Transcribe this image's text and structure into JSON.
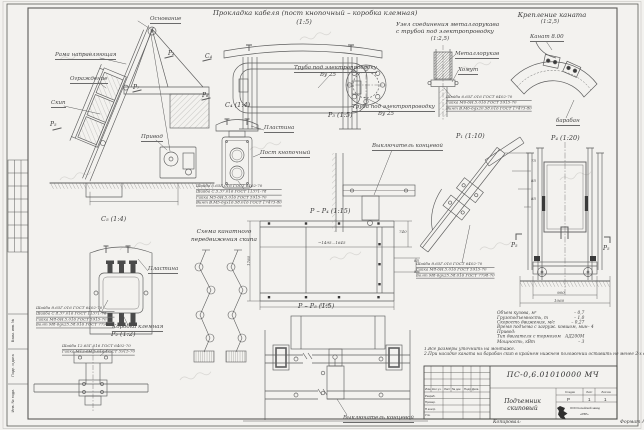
{
  "page": {
    "copied_label": "Копировал:",
    "format_label": "Формат А2"
  },
  "margin_labels": {
    "vzam_inv": "Взам. инв. №",
    "podp_data": "Подп. и дата",
    "inv_podl": "Инв. № подл."
  },
  "view_titles": {
    "cable_routing": "Прокладка кабеля (пост кнопочный – коробка клемная)",
    "cable_routing_scale": "(1:5)",
    "sleeve_line1": "Узел соединения металлорукава",
    "sleeve_line2": "с трубой под электропроводку",
    "sleeve_scale": "(1:2,5)",
    "rope_fastening": "Крепление каната",
    "rope_fastening_scale": "(1:2,5)",
    "rope_scheme_line1": "Схема канатного",
    "rope_scheme_line2": "передвижения скипа",
    "c4": "С₄ (1:4)",
    "c5": "С₅ (1:4)",
    "p1": "Р₁ (1:10)",
    "p3": "Р₃ (1:5)",
    "p2": "Р₂ (1:2)",
    "p4": "Р₄ (1:20)",
    "pp4": "Р – Р₄ (1:15)",
    "pp5": "Р – Р₅ (1:5)"
  },
  "part_labels": {
    "osnovanie": "Основание",
    "rama_napravl": "Рама направляющая",
    "ograzhdenie": "Ограждение",
    "skip": "Скип",
    "privod": "Привод",
    "plastina": "Пластина",
    "post_knopochny": "Пост кнопочный",
    "korobka_klemnaya": "Коробка клемная",
    "truba_elektro": "Труба под электропроводку",
    "truba_size": "Ву 25",
    "metallorukav": "Металлорукав",
    "khomut": "Хомут",
    "kanat_dim": "Канат 8.00",
    "baraban": "барабан",
    "vykl_kontsevoy": "Выключатель концевой"
  },
  "view_marks": {
    "p2": "Р₂",
    "p7": "Р₇",
    "p6": "Р₆",
    "p5": "Р₅",
    "c4": "С₄"
  },
  "callouts": {
    "c4_post": [
      "Шайба 5.65Г.016 ГОСТ 6402-70",
      "Шайба С.5.37.016 ГОСТ 11371-78",
      "Гайка М5-6Н.5.016 ГОСТ 5915-70",
      "Винт В.М5-6gх16.58.016 ГОСТ 17473-80"
    ],
    "c5_box": [
      "Шайба 8.65Г.016 ГОСТ 6402-70",
      "Шайба С.8.37.016 ГОСТ 11371-78",
      "Гайка М8-6Н.5.016 ГОСТ 5915-70",
      "Болт М8-6gх25.58.016 ГОСТ 7798-70"
    ],
    "p2_detail": [
      "Шайба 12.65Г.016 ГОСТ 6402-70",
      "Гайка М12-6Н.5.016 ГОСТ 5915-70"
    ],
    "sleeve": [
      "Шайба 6.65Г.016 ГОСТ 6402-70",
      "Гайка М6-6Н.5.016 ГОСТ 5915-70",
      "Винт В.М6-6gх20.58.016 ГОСТ 17473-80"
    ],
    "p1_rail": [
      "Шайба 8.65Г.016 ГОСТ 6402-70",
      "Гайка М8-6Н.5.016 ГОСТ 5915-70",
      "Болт М8-6gх25.58.016 ГОСТ 7798-70"
    ]
  },
  "dims": {
    "pp4_span": "~1495...1645",
    "pp4_bottom": "1730",
    "pp4_left": "1780",
    "pp4_right1": "740",
    "pp4_right2": "85",
    "pp4_right3": "85",
    "p4_base1": "960",
    "p4_base2": "1060",
    "p1_d1": "75",
    "p1_d2": "85",
    "p1_d3": "85"
  },
  "specs": {
    "rows": [
      {
        "label": "Объем кузова, м³",
        "value": "– 0,7"
      },
      {
        "label": "Грузоподъемность, т",
        "value": "– 1,0"
      },
      {
        "label": "Скорость движения, м/с",
        "value": "– 0,27"
      },
      {
        "label": "Время подъема с загруж. ковшом, мин",
        "value": "– 4"
      },
      {
        "label": "Привод:",
        "value": ""
      },
      {
        "label": "Тип двигателя с тормозом",
        "value": "АД200М"
      },
      {
        "label": "Мощность, кВт",
        "value": "– 3"
      }
    ],
    "notes": [
      "1.Все размеры уточнить на монтаже.",
      "2.При насадке каната на барабан скип в крайнем нижнем положении оставить не менее 2-х витков."
    ]
  },
  "title_block": {
    "doc_number": "ПС-0,6.01010000 МЧ",
    "doc_title": "Подъемник скиповый",
    "col_headers": [
      "Изм.",
      "Кол.уч.",
      "Лист",
      "№ док.",
      "Подп.",
      "Дата"
    ],
    "staff_rows": [
      "Разраб.",
      "Провер.",
      "Н.контр.",
      "Утв."
    ],
    "stage_header": "Стадия",
    "sheet_header": "Лист",
    "sheets_header": "Листов",
    "stage_value": "Р",
    "sheet_value": "1",
    "sheets_value": "1",
    "company_line1": "ООО Копейский завод",
    "company_line2": "«РЗР»"
  }
}
